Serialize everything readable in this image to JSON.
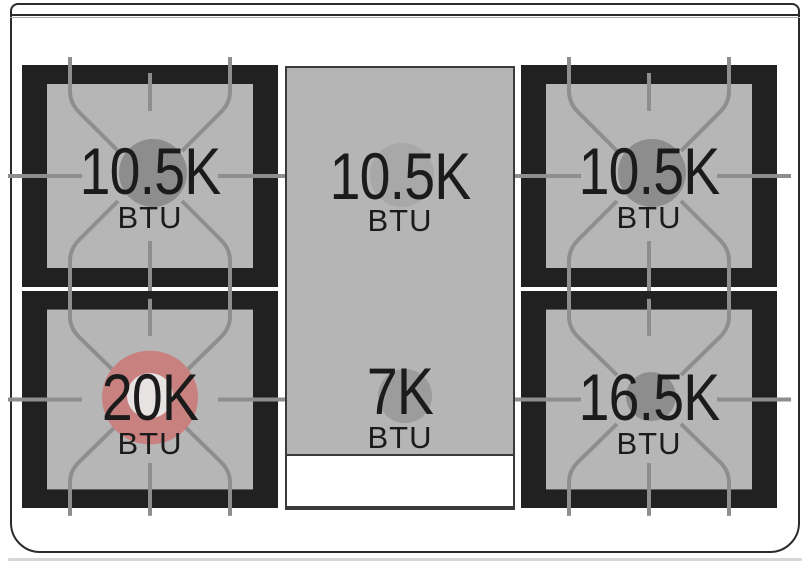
{
  "diagram": {
    "title": "range-cooktop-burner-layout",
    "burners": [
      {
        "position": "rear-left",
        "btu": "10.5K",
        "unit": "BTU",
        "indicator_color": "#8d8d8d"
      },
      {
        "position": "rear-center",
        "btu": "10.5K",
        "unit": "BTU",
        "indicator_color": "#a8a8a8"
      },
      {
        "position": "rear-right",
        "btu": "10.5K",
        "unit": "BTU",
        "indicator_color": "#8d8d8d"
      },
      {
        "position": "front-left",
        "btu": "20K",
        "unit": "BTU",
        "indicator_color": "#c98180",
        "indicator_inner_color": "#e7e3e2"
      },
      {
        "position": "front-center",
        "btu": "7K",
        "unit": "BTU",
        "indicator_color": "#9c9c9c"
      },
      {
        "position": "front-right",
        "btu": "16.5K",
        "unit": "BTU",
        "indicator_color": "#8d8d8d"
      }
    ],
    "colors": {
      "grate_black": "#212121",
      "surface_gray": "#b6b6b6",
      "grate_line_gray": "#8e8e8e",
      "panel_gray": "#b5b5b5",
      "frame_outline": "#2b2b2b",
      "text": "#1b1b1b",
      "highlight_red": "#c98180"
    }
  }
}
